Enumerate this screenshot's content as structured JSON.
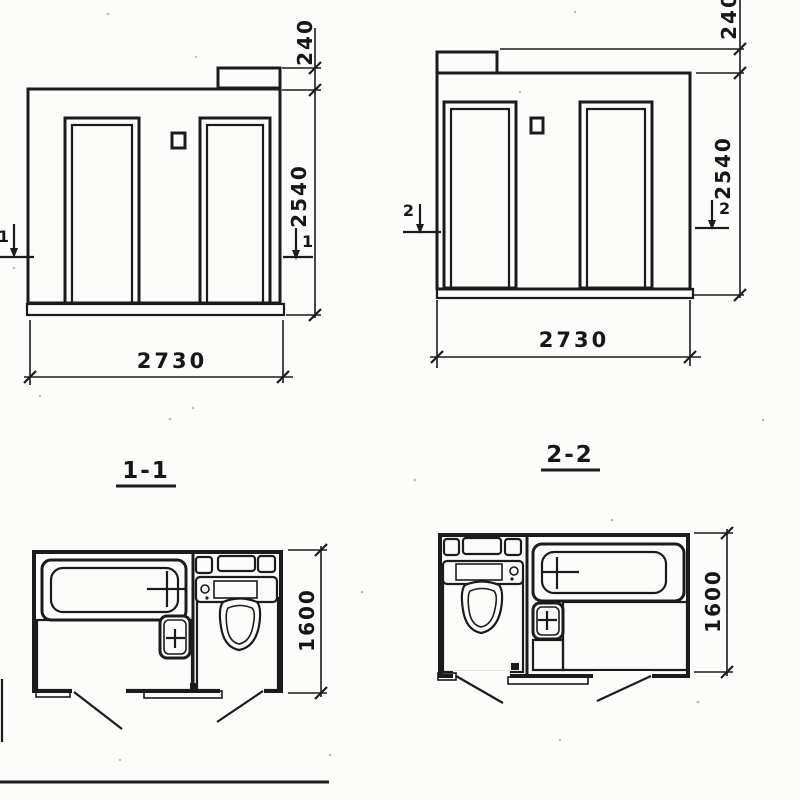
{
  "sheet": {
    "type": "scanned architectural drawing of a twin sanitary cabin block",
    "colors": {
      "ink": "#1b1b1b",
      "paper": "#fcfcfa"
    }
  },
  "elevation_left": {
    "parapet_height": "240",
    "body_height": "2540",
    "width": "2730",
    "section_marker": "1"
  },
  "elevation_right": {
    "parapet_height": "240",
    "body_height": "2540",
    "width": "2730",
    "section_marker": "2"
  },
  "plan_left": {
    "section_label": "1-1",
    "depth": "1600"
  },
  "plan_right": {
    "section_label": "2-2",
    "depth": "1600"
  }
}
